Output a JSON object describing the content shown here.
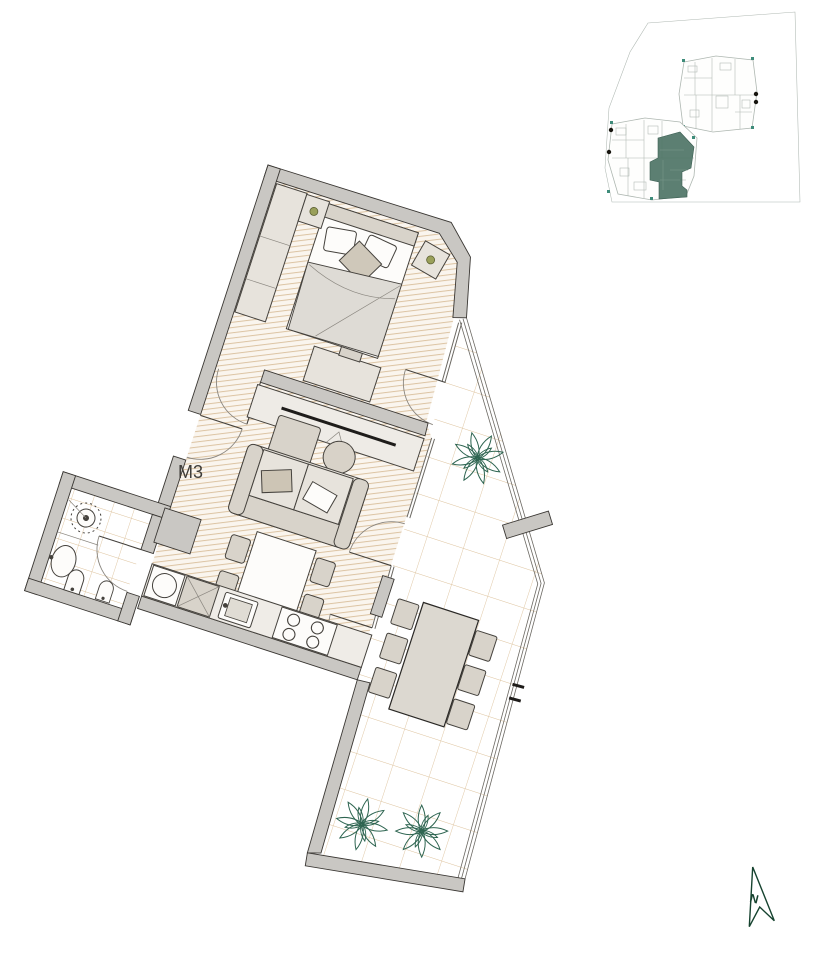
{
  "floor_plan": {
    "unit_label": "M3",
    "regions": [
      "bedroom",
      "living-dining",
      "kitchen",
      "bathroom",
      "terrace"
    ],
    "furniture_icons": [
      "double-bed-icon",
      "wardrobe-icon",
      "nightstand-lamp-icon",
      "dresser-icon",
      "tv-sideboard-icon",
      "sofa-icon",
      "ottoman-icon",
      "round-side-table-icon",
      "dining-table-icon",
      "dining-chair-icon",
      "washing-machine-icon",
      "dishwasher-icon",
      "kitchen-sink-icon",
      "cooktop-icon",
      "shower-icon",
      "washbasin-icon",
      "toilet-icon",
      "bidet-icon",
      "outdoor-dining-table-icon",
      "outdoor-chair-icon",
      "plant-icon",
      "door-swing-icon",
      "glass-railing-icon"
    ]
  },
  "key_plan": {
    "description": "site key plan with two building floor plates",
    "highlighted_unit": "M3",
    "buildings": [
      "upper-building",
      "lower-building-with-highlighted-unit"
    ]
  },
  "north_arrow": {
    "label": "N"
  },
  "colors": {
    "wall_fill": "#c9c7c3",
    "wall_outline": "#3a3733",
    "floor_base": "#faf5ee",
    "floor_hatch": "#dcc3a2",
    "tile_line": "#ddc29c",
    "glass_line": "#6b6862",
    "furniture_fill": "#e7e3dc",
    "furniture_dark": "#d8d3ca",
    "furniture_outline": "#45423d",
    "textile": "#dedbd5",
    "plant_green": "#2e6551",
    "keyplan_line": "#aeb7b1",
    "keyplan_green": "#4e7466",
    "north_green": "#16432f",
    "label_color": "#3f3d39"
  }
}
